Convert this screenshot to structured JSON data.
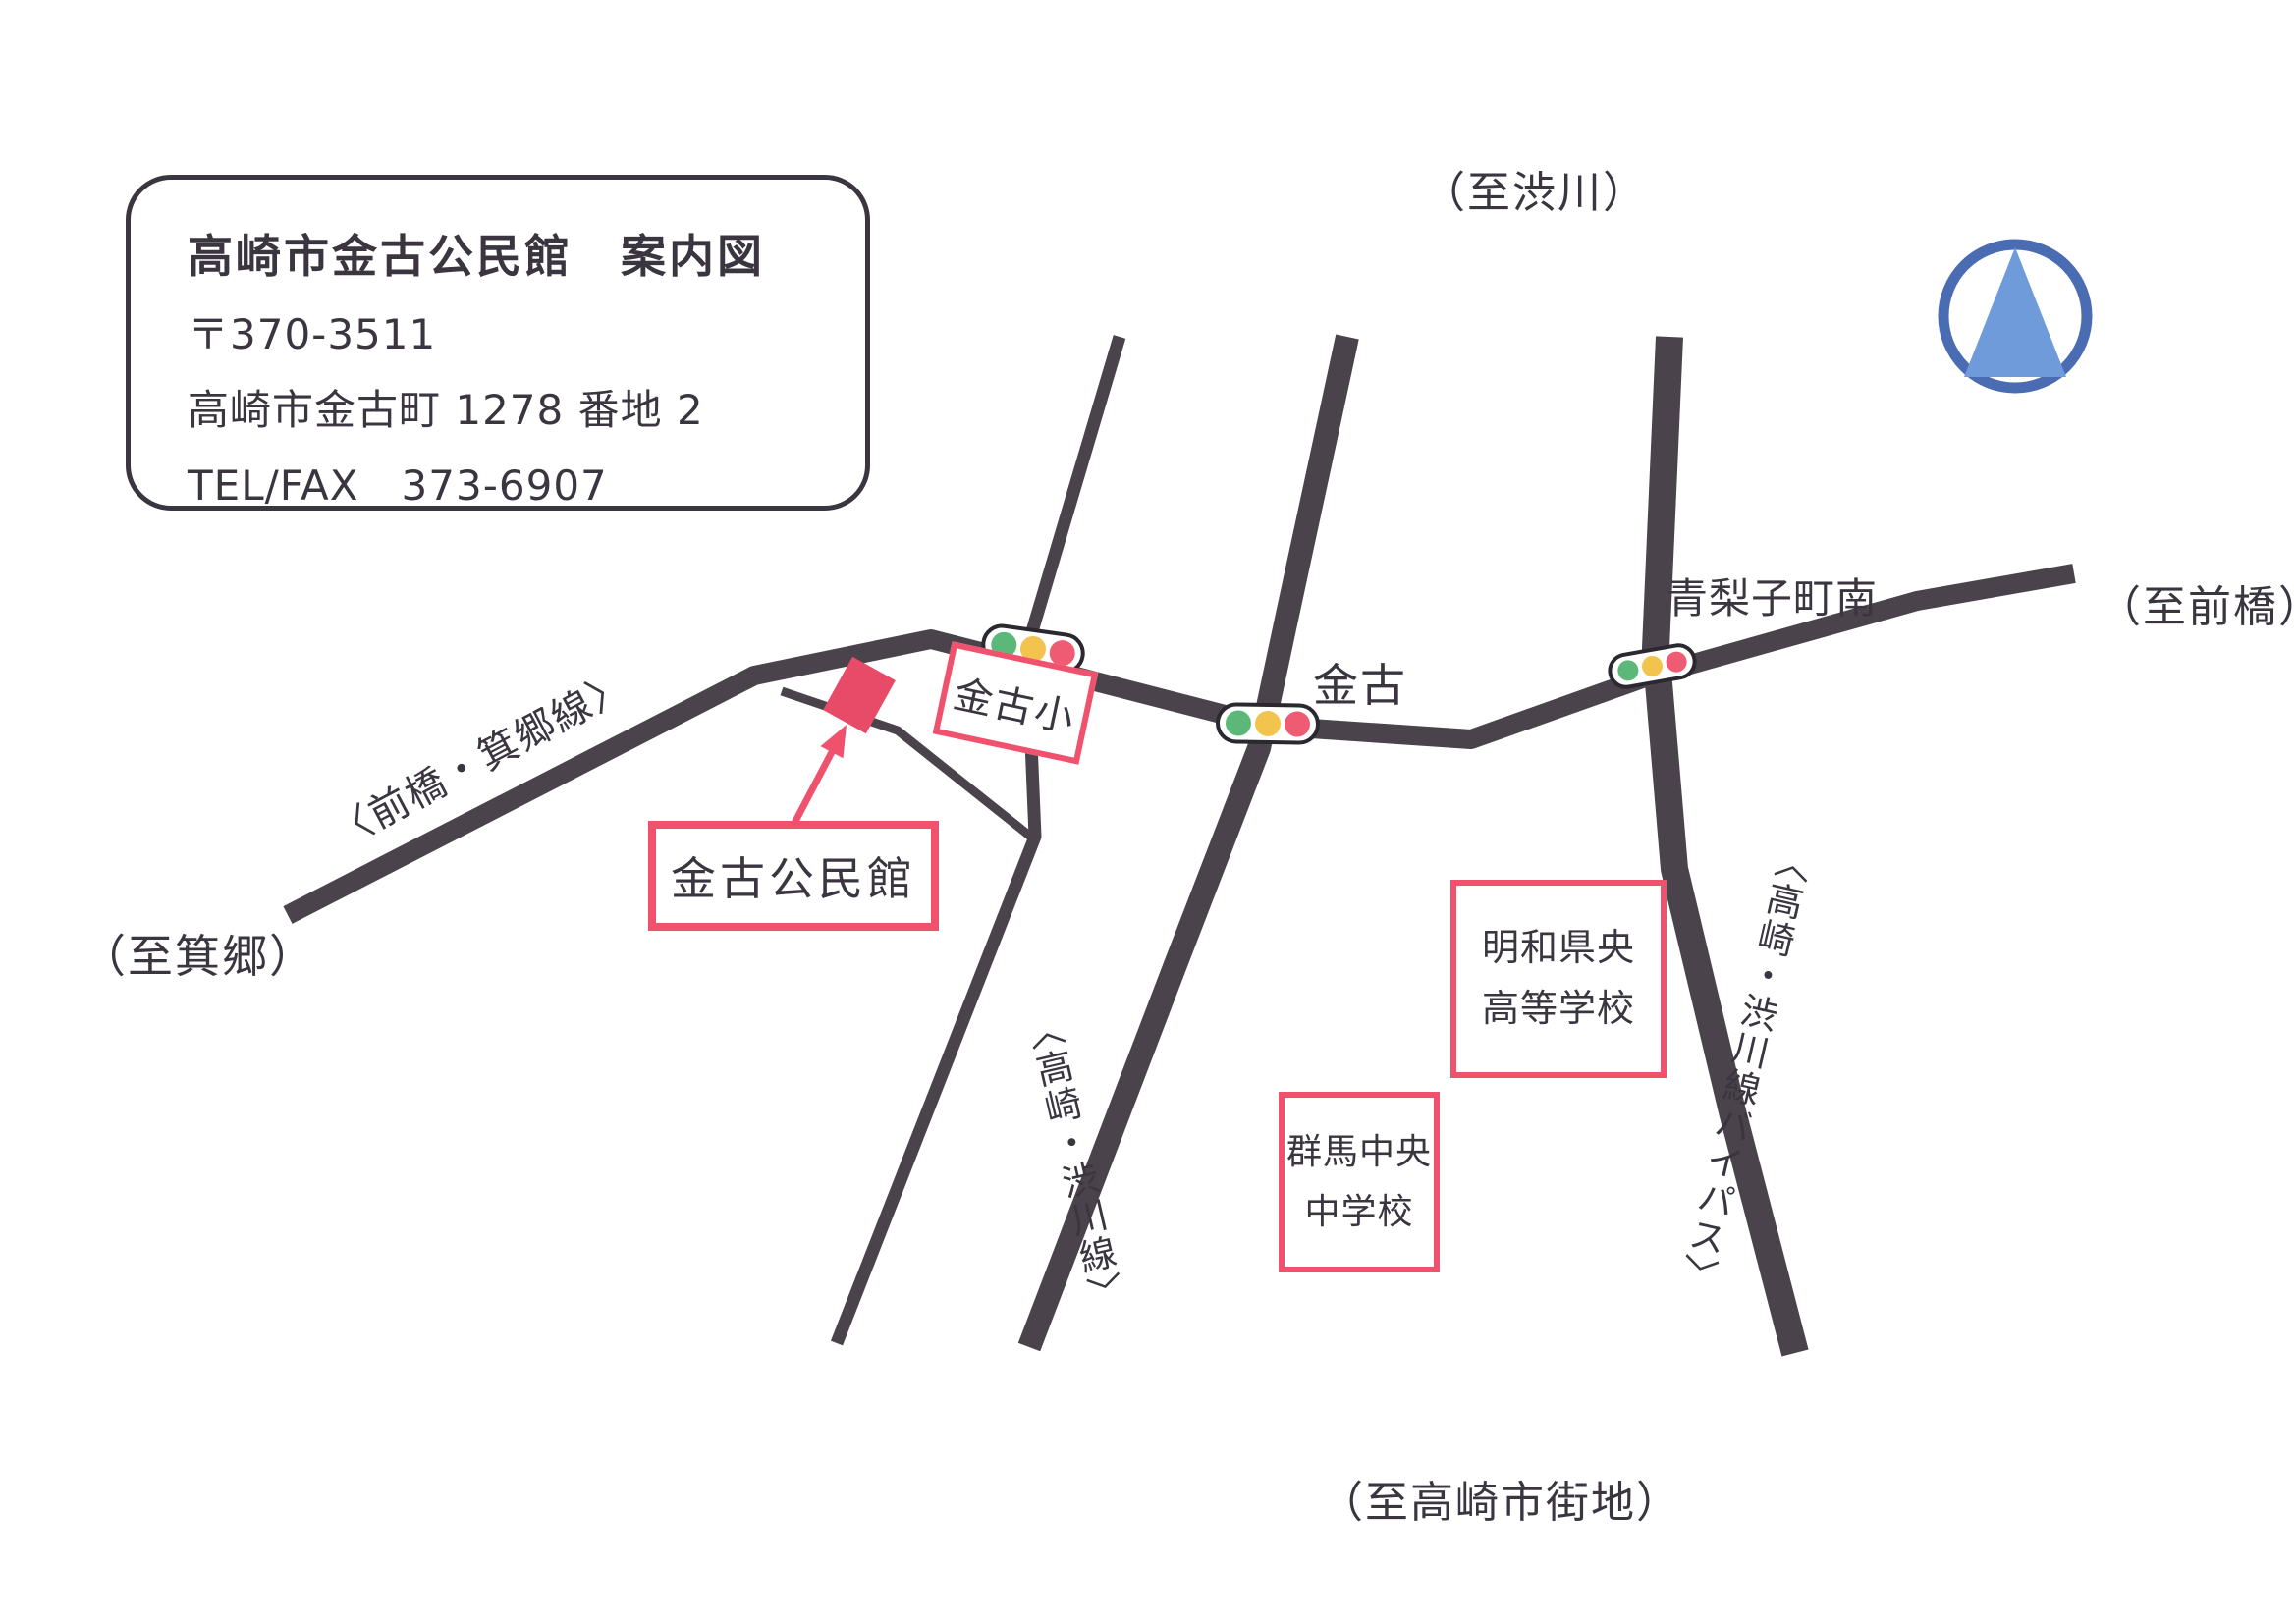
{
  "colors": {
    "road": "#4a434b",
    "ink": "#3b3540",
    "accent-pink": "#f0526e",
    "building-red": "#e84b68",
    "light-green": "#5cb878",
    "light-amber": "#f2c44d",
    "light-red": "#ee5b72",
    "north-ring": "#4a6cb3",
    "north-fill": "#6f9bda"
  },
  "title_box": {
    "title": "高崎市金古公民館　案内図",
    "postal": "〒370-3511",
    "address": "高崎市金古町 1278 番地 2",
    "telfax": "TEL/FAX　373-6907"
  },
  "directions": {
    "shibukawa": "（至渋川）",
    "maebashi": "（至前橋）",
    "misato": "（至箕郷）",
    "takasaki_city": "（至高崎市街地）"
  },
  "road_names": {
    "maebashi_misato": "〈前橋・箕郷線〉",
    "takasaki_shibukawa": "〈高崎・渋川線〉",
    "takasaki_shibukawa_bypass": "〈高崎・渋川線バイパス〉"
  },
  "intersections": {
    "aonashichou_minami": "青梨子町南",
    "kaneko": "金古"
  },
  "places": {
    "kaneko_elementary": "金古小",
    "community_center": "金古公民館",
    "meiwa_kenou_high_school": [
      "明和県央",
      "高等学校"
    ],
    "gunma_chuo_junior_high": [
      "群馬中央",
      "中学校"
    ]
  },
  "icons": {
    "north_arrow": "north-arrow-icon",
    "traffic_light": "traffic-light-icon",
    "community_center_building": "building-marker",
    "pointer_arrow": "arrow-pointer-icon"
  }
}
